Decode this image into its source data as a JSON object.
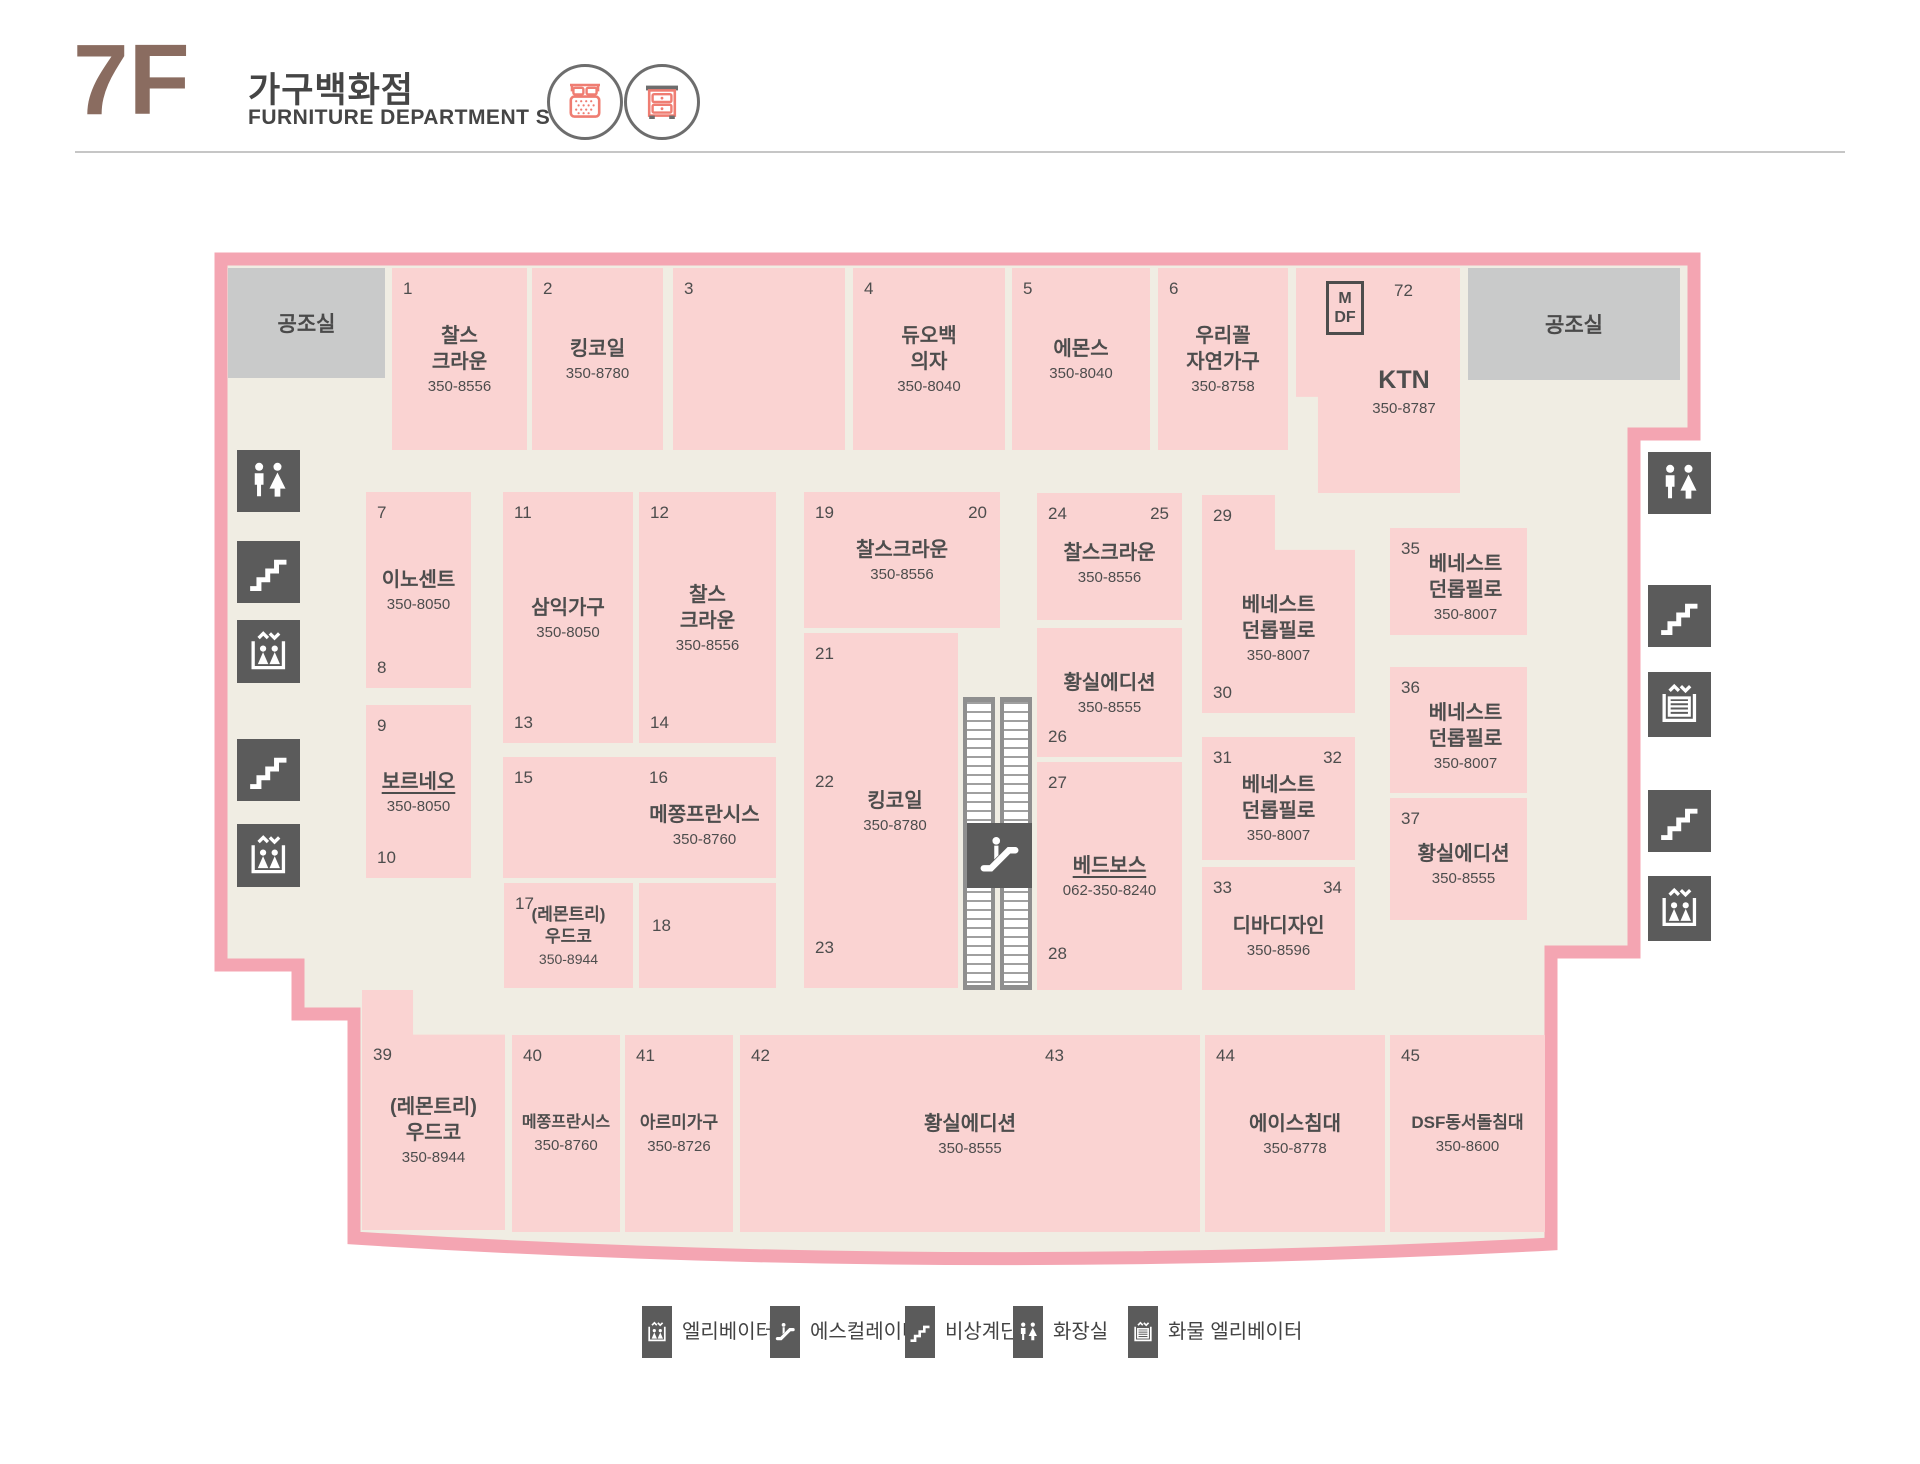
{
  "header": {
    "floor": "7F",
    "title_kr": "가구백화점",
    "title_en": "FURNITURE DEPARTMENT STORE"
  },
  "map": {
    "utility_left": "공조실",
    "utility_right": "공조실",
    "mdf": "MDF",
    "stores": [
      {
        "n1": "1",
        "name": "찰스\n크라운",
        "phone": "350-8556"
      },
      {
        "n1": "2",
        "name": "킹코일",
        "phone": "350-8780"
      },
      {
        "n1": "3"
      },
      {
        "n1": "4",
        "name": "듀오백\n의자",
        "phone": "350-8040"
      },
      {
        "n1": "5",
        "name": "에몬스",
        "phone": "350-8040"
      },
      {
        "n1": "6",
        "name": "우리꼴\n자연가구",
        "phone": "350-8758"
      },
      {
        "n1": "72",
        "name": "KTN",
        "phone": "350-8787"
      },
      {
        "n1": "7",
        "n2": "8",
        "name": "이노센트",
        "phone": "350-8050"
      },
      {
        "n1": "9",
        "n2": "10",
        "name": "보르네오",
        "phone": "350-8050"
      },
      {
        "n1": "11",
        "n2": "13",
        "name": "삼익가구",
        "phone": "350-8050"
      },
      {
        "n1": "12",
        "n2": "14",
        "name": "찰스\n크라운",
        "phone": "350-8556"
      },
      {
        "n1": "15",
        "n2": "16",
        "name": "메쫑프란시스",
        "phone": "350-8760"
      },
      {
        "n1": "17",
        "name": "(레몬트리)\n우드코",
        "phone": "350-8944"
      },
      {
        "n1": "18"
      },
      {
        "n1": "19",
        "n2": "20",
        "name": "찰스크라운",
        "phone": "350-8556"
      },
      {
        "n1": "21",
        "n2": "22",
        "n3": "23",
        "name": "킹코일",
        "phone": "350-8780"
      },
      {
        "n1": "24",
        "n2": "25",
        "name": "찰스크라운",
        "phone": "350-8556"
      },
      {
        "n1": "26",
        "name": "황실에디션",
        "phone": "350-8555"
      },
      {
        "n1": "27",
        "n2": "28",
        "name": "베드보스",
        "phone": "062-350-8240"
      },
      {
        "n1": "29",
        "n2": "30",
        "name": "베네스트\n던롭필로",
        "phone": "350-8007"
      },
      {
        "n1": "31",
        "n2": "32",
        "name": "베네스트\n던롭필로",
        "phone": "350-8007"
      },
      {
        "n1": "33",
        "n2": "34",
        "name": "디바디자인",
        "phone": "350-8596"
      },
      {
        "n1": "35",
        "name": "베네스트\n던롭필로",
        "phone": "350-8007"
      },
      {
        "n1": "36",
        "name": "베네스트\n던롭필로",
        "phone": "350-8007"
      },
      {
        "n1": "37",
        "name": "황실에디션",
        "phone": "350-8555"
      },
      {
        "n1": "39",
        "name": "(레몬트리)\n우드코",
        "phone": "350-8944"
      },
      {
        "n1": "40",
        "name": "메쫑프란시스",
        "phone": "350-8760"
      },
      {
        "n1": "41",
        "name": "아르미가구",
        "phone": "350-8726"
      },
      {
        "n1": "42",
        "n2": "43",
        "name": "황실에디션",
        "phone": "350-8555"
      },
      {
        "n1": "44",
        "name": "에이스침대",
        "phone": "350-8778"
      },
      {
        "n1": "45",
        "name": "DSF동서돌침대",
        "phone": "350-8600"
      }
    ]
  },
  "legend": {
    "items": [
      {
        "icon": "elevator-icon",
        "label": "엘리베이터"
      },
      {
        "icon": "escalator-icon",
        "label": "에스컬레이터"
      },
      {
        "icon": "emergency-stairs-icon",
        "label": "비상계단"
      },
      {
        "icon": "toilet-icon",
        "label": "화장실"
      },
      {
        "icon": "freight-elevator-icon",
        "label": "화물 엘리베이터"
      }
    ]
  },
  "colors": {
    "border_pink": "#f4a5b2",
    "unit_pink": "#fad3d2",
    "floor_cream": "#f0ede3",
    "icon_gray": "#5b5b5b",
    "utility_gray": "#c9caca",
    "coral": "#ef7d72",
    "brown": "#8a6c60",
    "text": "#4d4d4d"
  }
}
